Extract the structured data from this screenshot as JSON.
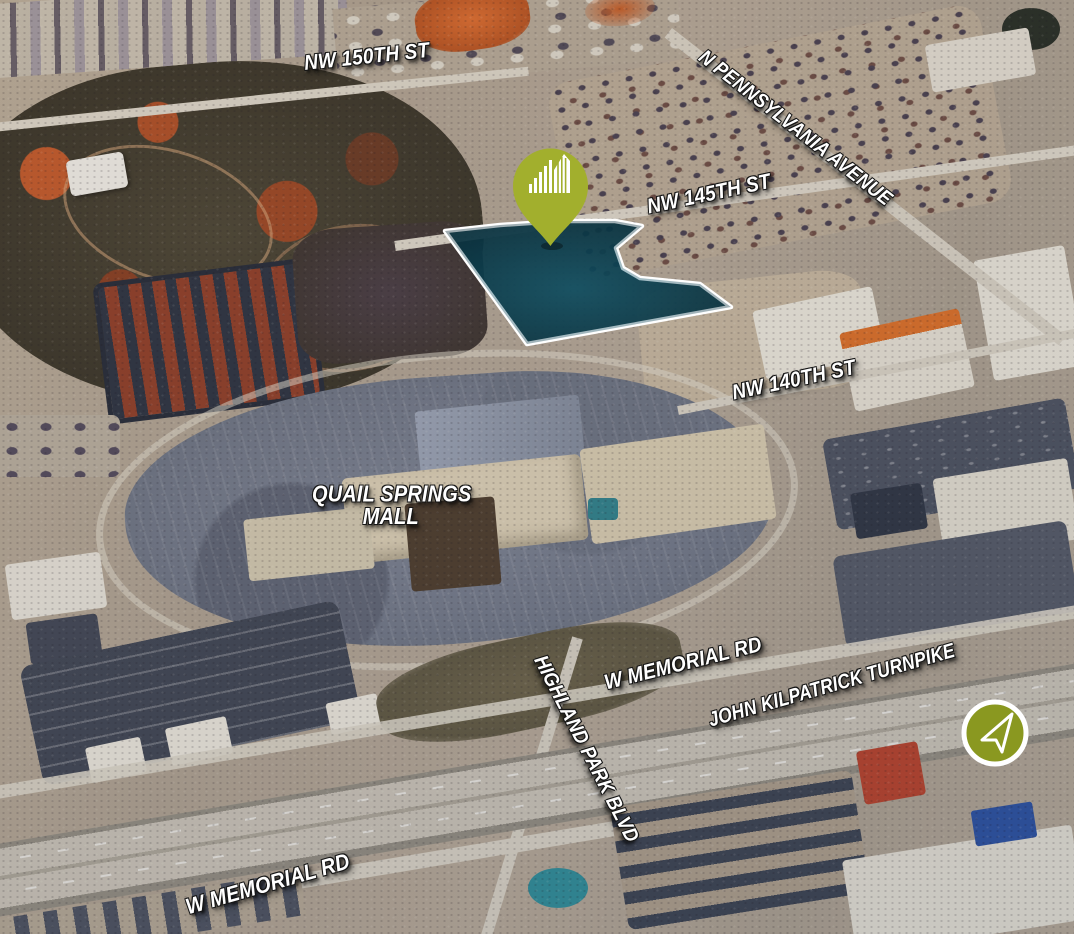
{
  "map": {
    "type": "aerial-property-map",
    "street_labels": {
      "nw_150th_st": "NW 150TH ST",
      "n_pennsylvania_avenue": "N PENNSYLVANIA AVENUE",
      "nw_145th_st": "NW 145TH ST",
      "nw_140th_st": "NW 140TH ST",
      "w_memorial_rd_upper": "W MEMORIAL RD",
      "john_kilpatrick_turnpike": "JOHN KILPATRICK TURNPIKE",
      "highland_park_blvd": "HIGHLAND PARK BLVD",
      "w_memorial_rd_lower": "W MEMORIAL RD"
    },
    "place_labels": {
      "mall_line1": "QUAIL SPRINGS",
      "mall_line2": "MALL"
    },
    "markers": {
      "property_pin": {
        "icon": "building-skyline-icon",
        "color": "#a2af2d"
      },
      "north_arrow": {
        "icon": "north-arrow-icon",
        "color": "#8a9820"
      }
    },
    "parcel_highlight": {
      "fill": "rgba(9,52,66,0.88)",
      "border": "#ffffff"
    },
    "label_style": {
      "color": "#ffffff"
    }
  }
}
